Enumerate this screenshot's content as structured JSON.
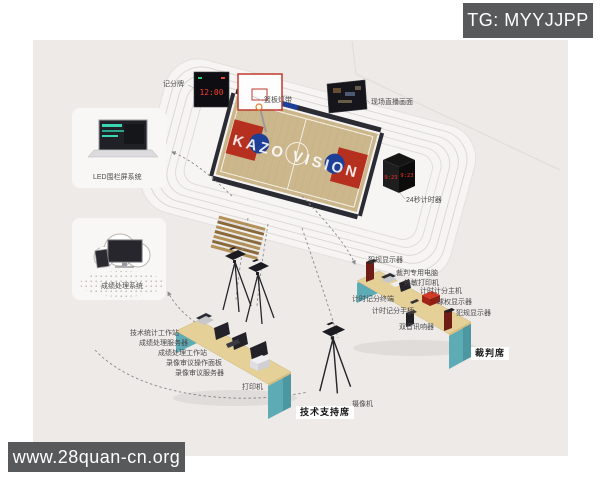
{
  "watermarks": {
    "top": "TG: MYYJJPP",
    "bottom": "www.28quan-cn.org"
  },
  "arena": {
    "court_brand": "KAZO VISION",
    "scoreboard_display": "12:00",
    "shot_clock_display": "9:23",
    "labels": {
      "scoreboard": "记分牌",
      "backboard_strip": "篮板灯带",
      "live_screen": "现场直播画面",
      "shot_clock": "24秒计时器"
    }
  },
  "system_cards": {
    "led_fence": {
      "label": "LED围栏屏系统"
    },
    "results_cloud": {
      "label": "成绩处理系统"
    }
  },
  "tech_desk": {
    "equipment_labels": [
      "技术统计工作站",
      "成绩处理服务器",
      "成绩处理工作站",
      "录像审议操作面板",
      "录像审议服务器",
      "打印机",
      "摄像机"
    ],
    "station_label": "技术支持席"
  },
  "referee_desk": {
    "equipment_labels": [
      "犯规显示器",
      "裁判专用电脑",
      "热敏打印机",
      "计时计分主机",
      "球权显示器",
      "犯规显示器",
      "计时记分终端",
      "计时记分手柄",
      "双音讯响器"
    ],
    "station_label": "裁判席"
  },
  "colors": {
    "canvas_bg": "#edeae8",
    "watermark_bg": "#58595b",
    "desk_teal": "#5cabb5",
    "desk_top": "#e5d097",
    "court_wood": "#ccb78c",
    "key_red": "#b5301f",
    "accent_blue": "#1e3f96",
    "led_red": "#ff2d20"
  }
}
